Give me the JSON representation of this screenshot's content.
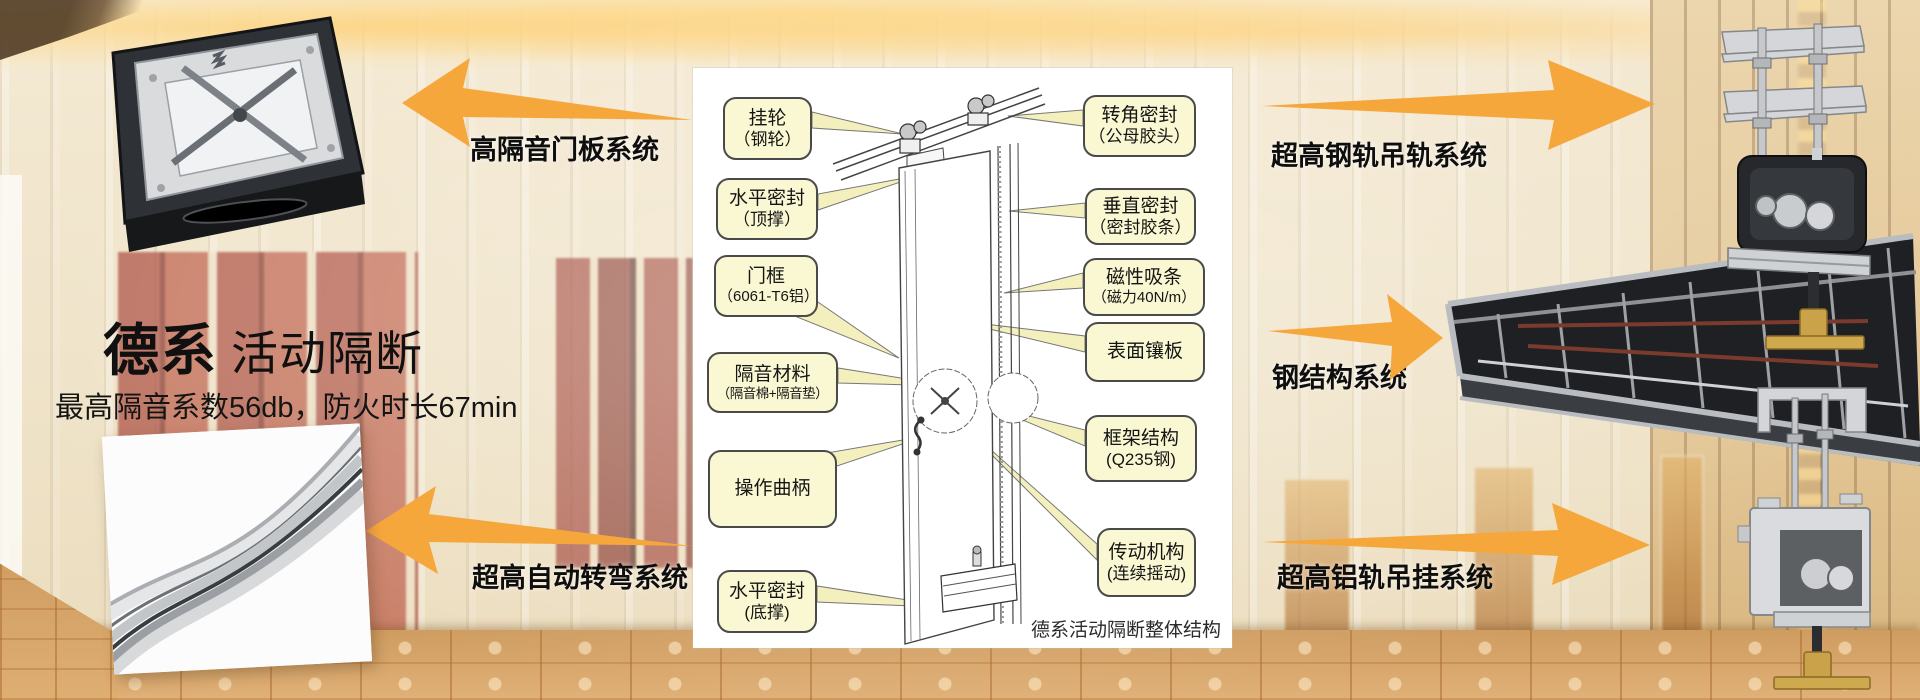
{
  "left": {
    "title_bold": "德系",
    "title_rest": "活动隔断",
    "subtitle": "最高隔音系数56db，防火时长67min"
  },
  "system_labels": {
    "door_panel": "高隔音门板系统",
    "auto_turn": "超高自动转弯系统",
    "steel_rail": "超高钢轨吊轨系统",
    "steel_structure": "钢结构系统",
    "alu_rail": "超高铝轨吊挂系统"
  },
  "diagram": {
    "caption": "德系活动隔断整体结构",
    "callouts_left": [
      {
        "line1": "挂轮",
        "line2": "（钢轮）"
      },
      {
        "line1": "水平密封",
        "line2": "（顶撑）"
      },
      {
        "line1": "门框",
        "line2": "（6061-T6铝）"
      },
      {
        "line1": "隔音材料",
        "line2": "（隔音棉+隔音垫）"
      },
      {
        "line1": "操作曲柄",
        "line2": ""
      },
      {
        "line1": "水平密封",
        "line2": "(底撑)"
      }
    ],
    "callouts_right": [
      {
        "line1": "转角密封",
        "line2": "（公母胶头）"
      },
      {
        "line1": "垂直密封",
        "line2": "（密封胶条）"
      },
      {
        "line1": "磁性吸条",
        "line2": "（磁力40N/m）"
      },
      {
        "line1": "表面镶板",
        "line2": ""
      },
      {
        "line1": "框架结构",
        "line2": "(Q235钢)"
      },
      {
        "line1": "传动机构",
        "line2": "(连续摇动)"
      }
    ]
  },
  "colors": {
    "arrow_orange": "#F6A73C",
    "callout_fill": "#FAF8D2",
    "callout_border": "#4A4A4A"
  }
}
